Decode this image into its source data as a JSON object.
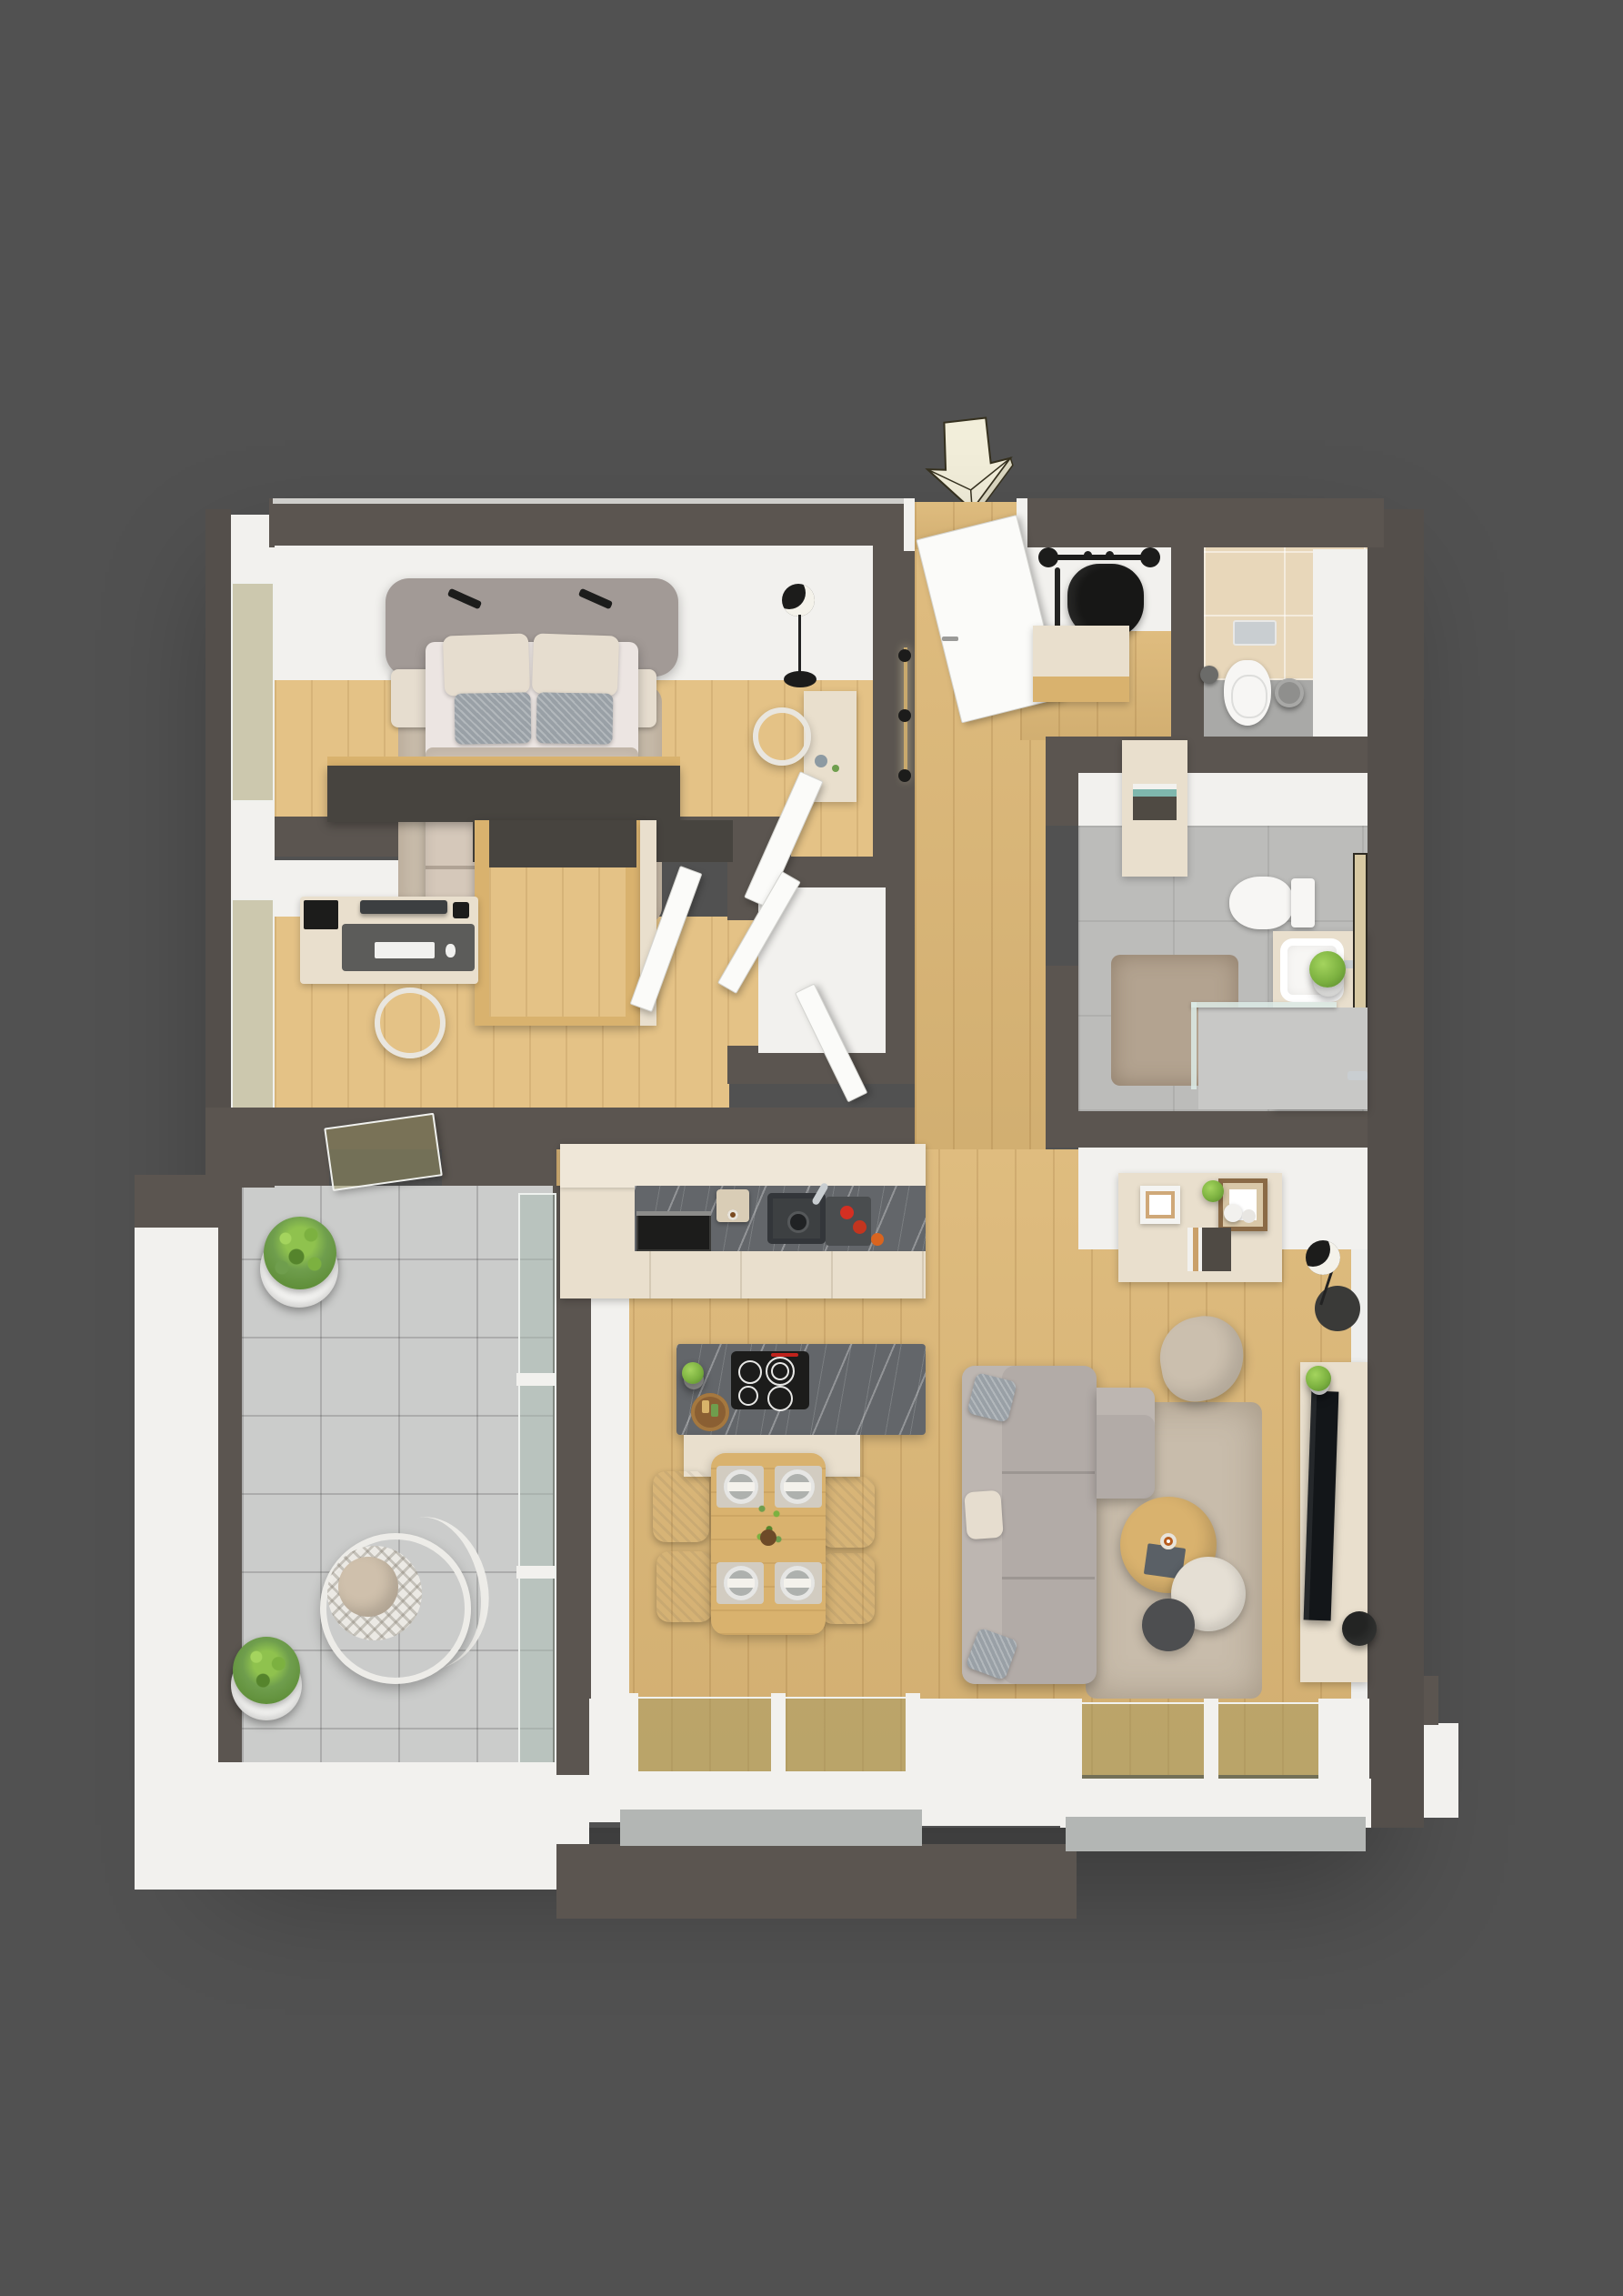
{
  "scene": {
    "kind": "3d-isometric-floor-plan-render",
    "subject": "one-bedroom apartment with office, two bathrooms, open kitchen-living area and terrace",
    "entrance_marker": "cream-3d-arrow-pointing-down",
    "visible_text": "",
    "rooms": [
      {
        "name": "bedroom",
        "furniture": [
          "double-bed",
          "headboard",
          "nightstand-left",
          "nightstand-right",
          "wall-lamp-left",
          "wall-lamp-right",
          "rug",
          "wardrobe",
          "vanity-desk",
          "vanity-chair",
          "floor-lamp"
        ]
      },
      {
        "name": "office",
        "furniture": [
          "desk",
          "desktop-computer",
          "keyboard",
          "desk-chair",
          "murphy-bed-wardrobe"
        ]
      },
      {
        "name": "hallway",
        "furniture": [
          "entrance-door",
          "wall-light-bar",
          "storage-closet"
        ]
      },
      {
        "name": "entry",
        "furniture": [
          "coat-rack",
          "jacket",
          "umbrella",
          "shoe-sideboard"
        ]
      },
      {
        "name": "wc",
        "furniture": [
          "wall-hung-toilet",
          "flush-plate",
          "toilet-brush",
          "waste-bin"
        ]
      },
      {
        "name": "bathroom",
        "furniture": [
          "tall-cabinet",
          "toilet",
          "washbasin-vanity",
          "mirror",
          "towels",
          "plant",
          "walk-in-shower",
          "rug"
        ]
      },
      {
        "name": "kitchen",
        "furniture": [
          "cabinet-run",
          "built-in-oven",
          "coffee-machine",
          "sink",
          "cutting-board",
          "fruit",
          "island",
          "induction-cooktop",
          "serving-tray",
          "herb-pot"
        ]
      },
      {
        "name": "dining",
        "furniture": [
          "dining-table",
          "place-settings",
          "centerpiece",
          "chair-x4"
        ]
      },
      {
        "name": "living-room",
        "furniture": [
          "l-shaped-sofa",
          "cushions",
          "pouf",
          "shaggy-rug",
          "nesting-coffee-tables",
          "tv-sideboard",
          "tv",
          "floor-lamp",
          "black-vase",
          "hall-sideboard",
          "picture-frames"
        ]
      },
      {
        "name": "terrace",
        "furniture": [
          "planter-large",
          "planter-small",
          "hanging-egg-chair",
          "glass-balustrade"
        ]
      }
    ]
  },
  "palette": {
    "bg": "#515151",
    "wallDark": "#5b5550",
    "wallDarker": "#544f4b",
    "whiteFace": "#f2f1ee",
    "wood": "#ddb877",
    "woodLight": "#e4c286",
    "woodFurn": "#d9b26e",
    "terrace": "#cbcccb",
    "tileWC": "#e8d7ba",
    "bathFloor": "#bcbcba",
    "cream": "#e9dfcd",
    "creamLight": "#efe7d8",
    "marble": "#63666a",
    "sofa": "#b2aba7",
    "sofaLight": "#bdb6b1",
    "rugLiving": "#c8bcab",
    "rugBed": "#cbbfae",
    "rugBath": "#b3a390",
    "bedHead": "#a29a96",
    "duvet": "#d5c8ba",
    "mattress": "#ece5e2",
    "pillowBeige": "#e6ddcf",
    "pillowGray": "#99a0a6",
    "black": "#1c1c1b",
    "dark": "#47443f",
    "glass": "rgba(168,186,178,0.5)",
    "glassWood": "rgba(158,150,96,0.45)",
    "green": "#7cb140",
    "greenLight": "#a4d45e",
    "greenDark": "#55842c",
    "chrome": "#c9ced1",
    "arrow": "#f2eeda",
    "arrowEdge": "#36311f"
  }
}
